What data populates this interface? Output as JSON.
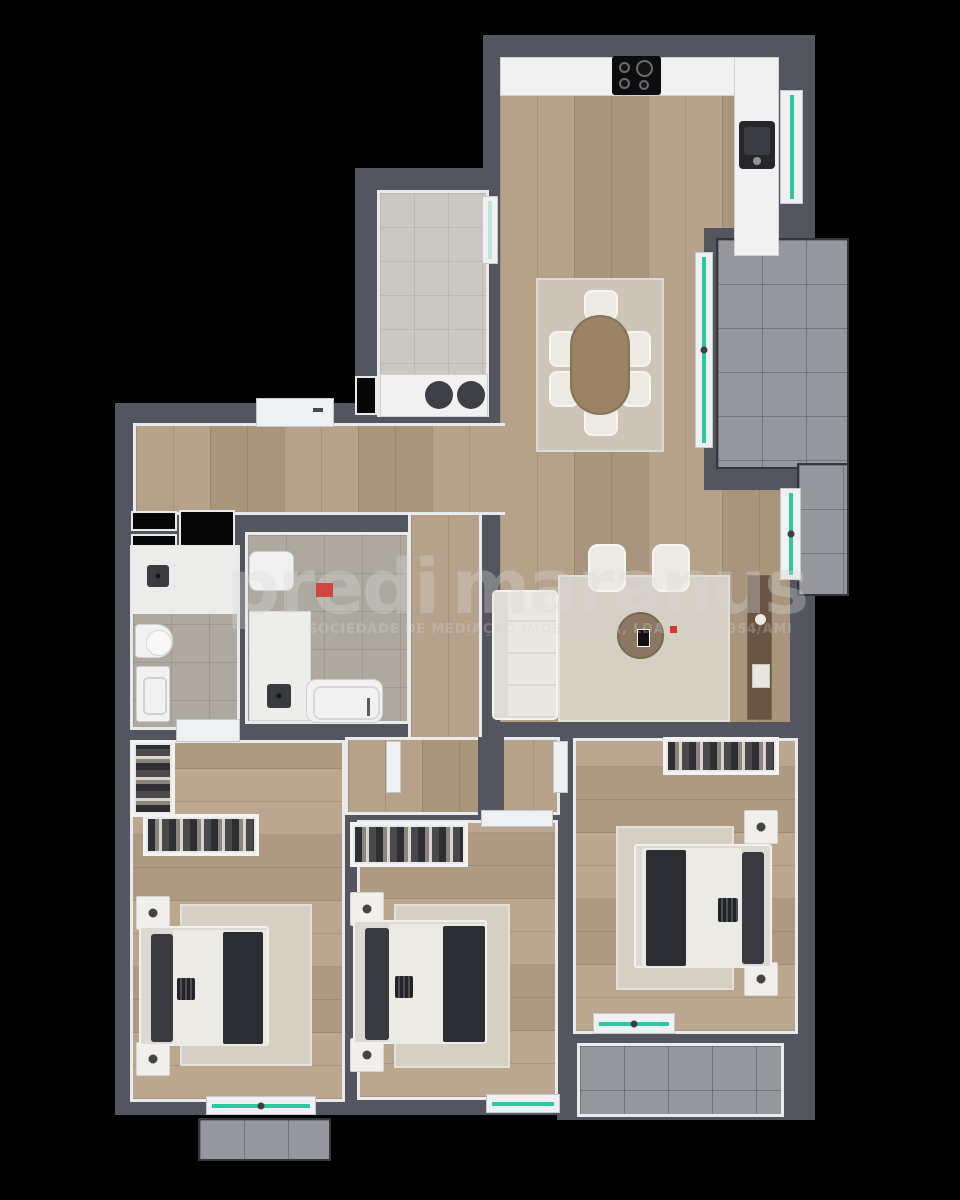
{
  "watermark": {
    "brand_pr": "pr",
    "brand_e": "e",
    "brand_di": "di",
    "brand_maranus": "maranus",
    "subtitle_company": "SOCIEDADE DE MEDIAÇÃO IMOBILIÁRIA, LDA",
    "subtitle_license": "LIC. 2954/AMI"
  },
  "colors": {
    "background": "#000000",
    "wall": "#54565f",
    "wall_trim": "#e9eaec",
    "wood_floor": "#b29c83",
    "bedroom_floor": "#b7a189",
    "bathroom_tile": "#aea99f",
    "laundry_tile": "#cbc8c1",
    "balcony_tile": "#96979d",
    "window_glass": "#2ec7a0",
    "accent_red": "#d33a35",
    "rug": "#d5cfc4",
    "sofa": "#eae7e0",
    "dark_furniture": "#2c2d32",
    "sideboard_wood": "#6a5543",
    "table_wood": "#9b8265"
  }
}
